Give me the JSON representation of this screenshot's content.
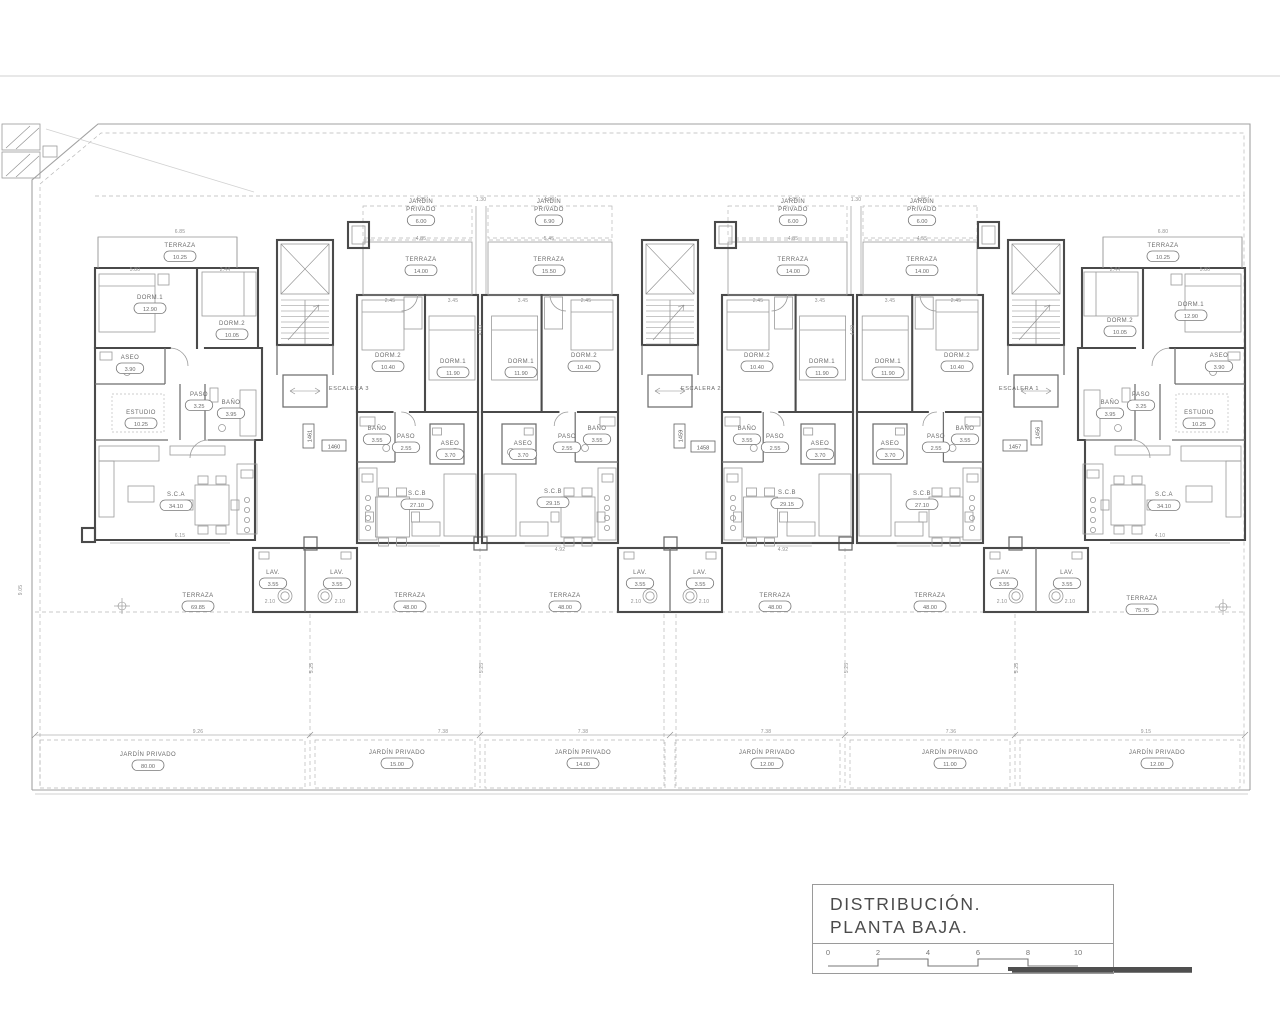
{
  "title_block": {
    "line1": "DISTRIBUCIÓN.",
    "line2": "PLANTA BAJA.",
    "scale_ticks": [
      "0",
      "2",
      "4",
      "6",
      "8",
      "10"
    ]
  },
  "colors": {
    "wall": "#4a4a4a",
    "thin": "#9a9a9a",
    "boundary": "#b8b8b8",
    "label_text": "#6b6b6b"
  },
  "plan": {
    "escaleras": [
      {
        "label": "ESCALERA 3",
        "x": 349,
        "y": 390
      },
      {
        "label": "ESCALERA 2",
        "x": 701,
        "y": 390
      },
      {
        "label": "ESCALERA 1",
        "x": 1019,
        "y": 390
      }
    ],
    "unit_plates": [
      {
        "n": "1461",
        "x": 310,
        "y": 436,
        "vert": true
      },
      {
        "n": "1460",
        "x": 334,
        "y": 447,
        "vert": false
      },
      {
        "n": "1459",
        "x": 681,
        "y": 436,
        "vert": true
      },
      {
        "n": "1458",
        "x": 703,
        "y": 448,
        "vert": false
      },
      {
        "n": "1457",
        "x": 1015,
        "y": 447,
        "vert": false
      },
      {
        "n": "1456",
        "x": 1038,
        "y": 433,
        "vert": true
      }
    ],
    "rooms": [
      {
        "l": "TERRAZA",
        "v": "10.25",
        "x": 180,
        "y": 247
      },
      {
        "l": "DORM.1",
        "v": "12.90",
        "x": 150,
        "y": 299
      },
      {
        "l": "DORM.2",
        "v": "10.05",
        "x": 232,
        "y": 325
      },
      {
        "l": "ASEO",
        "v": "3.90",
        "x": 130,
        "y": 359
      },
      {
        "l": "PASO",
        "v": "3.25",
        "x": 199,
        "y": 396
      },
      {
        "l": "BAÑO",
        "v": "3.95",
        "x": 231,
        "y": 404
      },
      {
        "l": "ESTUDIO",
        "v": "10.25",
        "x": 141,
        "y": 414
      },
      {
        "l": "S.C.A",
        "v": "34.10",
        "x": 176,
        "y": 496
      },
      {
        "l": "LAV.",
        "v": "3.55",
        "x": 273,
        "y": 574
      },
      {
        "l": "TERRAZA",
        "v": "69.85",
        "x": 198,
        "y": 597
      },
      {
        "l": "JARDÍN PRIVADO",
        "v": "80.00",
        "x": 148,
        "y": 756
      },
      {
        "l": "JARDÍN",
        "l2": "PRIVADO",
        "v": "6.00",
        "x": 421,
        "y": 211
      },
      {
        "l": "TERRAZA",
        "v": "14.00",
        "x": 421,
        "y": 261
      },
      {
        "l": "DORM.2",
        "v": "10.40",
        "x": 388,
        "y": 357
      },
      {
        "l": "DORM.1",
        "v": "11.90",
        "x": 453,
        "y": 363
      },
      {
        "l": "BAÑO",
        "v": "3.55",
        "x": 377,
        "y": 430
      },
      {
        "l": "PASO",
        "v": "2.55",
        "x": 406,
        "y": 438
      },
      {
        "l": "ASEO",
        "v": "3.70",
        "x": 450,
        "y": 445
      },
      {
        "l": "S.C.B",
        "v": "27.10",
        "x": 417,
        "y": 495
      },
      {
        "l": "LAV.",
        "v": "3.55",
        "x": 337,
        "y": 574
      },
      {
        "l": "TERRAZA",
        "v": "48.00",
        "x": 410,
        "y": 597
      },
      {
        "l": "JARDÍN PRIVADO",
        "v": "15.00",
        "x": 397,
        "y": 754
      },
      {
        "l": "JARDÍN",
        "l2": "PRIVADO",
        "v": "6.90",
        "x": 549,
        "y": 211
      },
      {
        "l": "TERRAZA",
        "v": "15.50",
        "x": 549,
        "y": 261
      },
      {
        "l": "DORM.1",
        "v": "11.90",
        "x": 521,
        "y": 363
      },
      {
        "l": "DORM.2",
        "v": "10.40",
        "x": 584,
        "y": 357
      },
      {
        "l": "ASEO",
        "v": "3.70",
        "x": 523,
        "y": 445
      },
      {
        "l": "PASO",
        "v": "2.55",
        "x": 567,
        "y": 438
      },
      {
        "l": "BAÑO",
        "v": "3.55",
        "x": 597,
        "y": 430
      },
      {
        "l": "S.C.B",
        "v": "29.15",
        "x": 553,
        "y": 493
      },
      {
        "l": "LAV.",
        "v": "3.55",
        "x": 640,
        "y": 574
      },
      {
        "l": "TERRAZA",
        "v": "48.00",
        "x": 565,
        "y": 597
      },
      {
        "l": "JARDÍN PRIVADO",
        "v": "14.00",
        "x": 583,
        "y": 754
      },
      {
        "l": "JARDÍN",
        "l2": "PRIVADO",
        "v": "6.00",
        "x": 793,
        "y": 211
      },
      {
        "l": "TERRAZA",
        "v": "14.00",
        "x": 793,
        "y": 261
      },
      {
        "l": "DORM.2",
        "v": "10.40",
        "x": 757,
        "y": 357
      },
      {
        "l": "DORM.1",
        "v": "11.90",
        "x": 822,
        "y": 363
      },
      {
        "l": "BAÑO",
        "v": "3.55",
        "x": 747,
        "y": 430
      },
      {
        "l": "PASO",
        "v": "2.55",
        "x": 775,
        "y": 438
      },
      {
        "l": "ASEO",
        "v": "3.70",
        "x": 820,
        "y": 445
      },
      {
        "l": "S.C.B",
        "v": "29.15",
        "x": 787,
        "y": 494
      },
      {
        "l": "LAV.",
        "v": "3.55",
        "x": 700,
        "y": 574
      },
      {
        "l": "TERRAZA",
        "v": "48.00",
        "x": 775,
        "y": 597
      },
      {
        "l": "JARDÍN PRIVADO",
        "v": "12.00",
        "x": 767,
        "y": 754
      },
      {
        "l": "JARDÍN",
        "l2": "PRIVADO",
        "v": "6.00",
        "x": 922,
        "y": 211
      },
      {
        "l": "TERRAZA",
        "v": "14.00",
        "x": 922,
        "y": 261
      },
      {
        "l": "DORM.1",
        "v": "11.90",
        "x": 888,
        "y": 363
      },
      {
        "l": "DORM.2",
        "v": "10.40",
        "x": 957,
        "y": 357
      },
      {
        "l": "ASEO",
        "v": "3.70",
        "x": 890,
        "y": 445
      },
      {
        "l": "PASO",
        "v": "2.55",
        "x": 936,
        "y": 438
      },
      {
        "l": "BAÑO",
        "v": "3.55",
        "x": 965,
        "y": 430
      },
      {
        "l": "S.C.B",
        "v": "27.10",
        "x": 922,
        "y": 495
      },
      {
        "l": "LAV.",
        "v": "3.55",
        "x": 1004,
        "y": 574
      },
      {
        "l": "TERRAZA",
        "v": "48.00",
        "x": 930,
        "y": 597
      },
      {
        "l": "JARDÍN PRIVADO",
        "v": "11.00",
        "x": 950,
        "y": 754
      },
      {
        "l": "TERRAZA",
        "v": "10.25",
        "x": 1163,
        "y": 247
      },
      {
        "l": "DORM.1",
        "v": "12.90",
        "x": 1191,
        "y": 306
      },
      {
        "l": "DORM.2",
        "v": "10.05",
        "x": 1120,
        "y": 322
      },
      {
        "l": "ASEO",
        "v": "3.90",
        "x": 1219,
        "y": 357
      },
      {
        "l": "PASO",
        "v": "3.25",
        "x": 1141,
        "y": 396
      },
      {
        "l": "BAÑO",
        "v": "3.95",
        "x": 1110,
        "y": 404
      },
      {
        "l": "ESTUDIO",
        "v": "10.25",
        "x": 1199,
        "y": 414
      },
      {
        "l": "S.C.A",
        "v": "34.10",
        "x": 1164,
        "y": 496
      },
      {
        "l": "LAV.",
        "v": "3.55",
        "x": 1067,
        "y": 574
      },
      {
        "l": "TERRAZA",
        "v": "75.75",
        "x": 1142,
        "y": 600
      },
      {
        "l": "JARDÍN PRIVADO",
        "v": "12.00",
        "x": 1157,
        "y": 754
      }
    ],
    "dims": [
      [
        421,
        201,
        "4.35"
      ],
      [
        481,
        201,
        "1.30"
      ],
      [
        549,
        201,
        "4.90"
      ],
      [
        793,
        201,
        "4.35"
      ],
      [
        856,
        201,
        "1.30"
      ],
      [
        922,
        201,
        "4.55"
      ],
      [
        180,
        233,
        "6.85"
      ],
      [
        421,
        240,
        "4.85"
      ],
      [
        549,
        240,
        "5.45"
      ],
      [
        793,
        240,
        "4.85"
      ],
      [
        922,
        240,
        "4.55"
      ],
      [
        1163,
        233,
        "6.80"
      ],
      [
        390,
        302,
        "2.45"
      ],
      [
        453,
        302,
        "3.45"
      ],
      [
        523,
        302,
        "3.45"
      ],
      [
        586,
        302,
        "2.45"
      ],
      [
        758,
        302,
        "2.45"
      ],
      [
        820,
        302,
        "3.45"
      ],
      [
        890,
        302,
        "3.45"
      ],
      [
        956,
        302,
        "2.45"
      ],
      [
        135,
        271,
        "5.80"
      ],
      [
        225,
        271,
        "2.44"
      ],
      [
        1115,
        271,
        "2.44"
      ],
      [
        1205,
        271,
        "5.80"
      ],
      [
        180,
        537,
        "6.15"
      ],
      [
        560,
        551,
        "4.92"
      ],
      [
        783,
        551,
        "4.92"
      ],
      [
        1160,
        537,
        "4.10"
      ],
      [
        270,
        603,
        "2.10"
      ],
      [
        340,
        603,
        "2.10"
      ],
      [
        636,
        603,
        "2.10"
      ],
      [
        704,
        603,
        "2.10"
      ],
      [
        1002,
        603,
        "2.10"
      ],
      [
        1070,
        603,
        "2.10"
      ],
      [
        198,
        733,
        "9.26"
      ],
      [
        443,
        733,
        "7.38"
      ],
      [
        583,
        733,
        "7.38"
      ],
      [
        766,
        733,
        "7.38"
      ],
      [
        951,
        733,
        "7.36"
      ],
      [
        1146,
        733,
        "9.15"
      ],
      [
        313,
        668,
        "5.25",
        1
      ],
      [
        483,
        668,
        "5.25",
        1
      ],
      [
        848,
        668,
        "5.25",
        1
      ],
      [
        1018,
        668,
        "5.25",
        1
      ],
      [
        482,
        330,
        "4.00",
        1
      ],
      [
        854,
        330,
        "4.00",
        1
      ],
      [
        22,
        590,
        "9.05",
        1
      ]
    ]
  }
}
